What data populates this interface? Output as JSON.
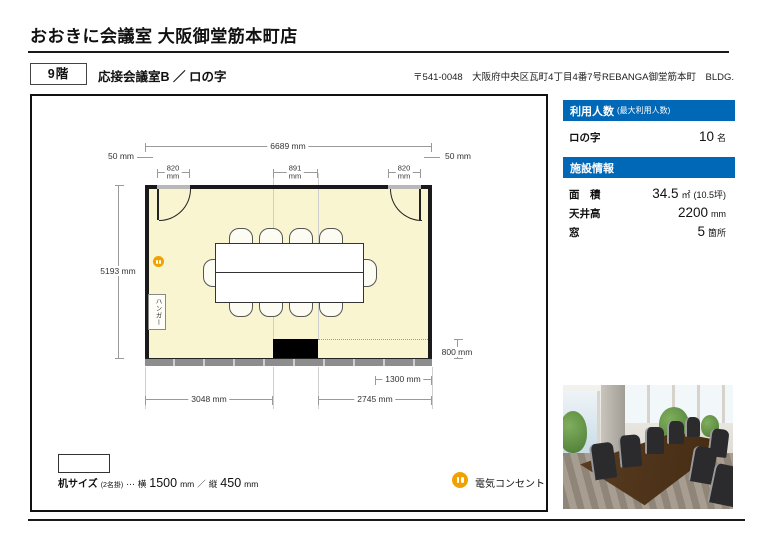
{
  "header": {
    "title": "おおきに会議室 大阪御堂筋本町店",
    "floor": "9階",
    "room": "応接会議室B ／ ロの字",
    "address": "〒541-0048　大阪府中央区瓦町4丁目4番7号REBANGA御堂筋本町　BLDG."
  },
  "colors": {
    "accent_blue": "#0068b7",
    "room_fill": "#f9f5d1",
    "outlet_orange": "#f0a202"
  },
  "sidebar": {
    "capacity": {
      "header": "利用人数",
      "header_note": "(最大利用人数)",
      "row_label": "ロの字",
      "value": "10",
      "unit": "名"
    },
    "facility": {
      "header": "施設情報",
      "rows": [
        {
          "label": "面　積",
          "value": "34.5",
          "unit": "㎡",
          "note": "(10.5坪)"
        },
        {
          "label": "天井高",
          "value": "2200",
          "unit": "mm"
        },
        {
          "label": "窓",
          "value": "5",
          "unit": "箇所"
        }
      ]
    }
  },
  "floorplan": {
    "dims": {
      "total_width": "6689 mm",
      "gap_left": "50 mm",
      "gap_right": "50 mm",
      "door_left_value": "820",
      "door_left_unit": "mm",
      "pillar_width_value": "891",
      "pillar_width_unit": "mm",
      "door_right_value": "820",
      "door_right_unit": "mm",
      "room_depth": "5193 mm",
      "pillar_depth": "800 mm",
      "window_right": "1300 mm",
      "bottom_left": "3048 mm",
      "bottom_right": "2745 mm"
    },
    "hanger_label": "ハンガー"
  },
  "legend": {
    "desk": {
      "label": "机サイズ",
      "note": "(2名掛)",
      "dots": "⋯",
      "width_prefix": "横",
      "width_value": "1500",
      "width_unit": "mm",
      "separator": "／",
      "height_prefix": "縦",
      "height_value": "450",
      "height_unit": "mm"
    },
    "outlet_label": "電気コンセント"
  }
}
